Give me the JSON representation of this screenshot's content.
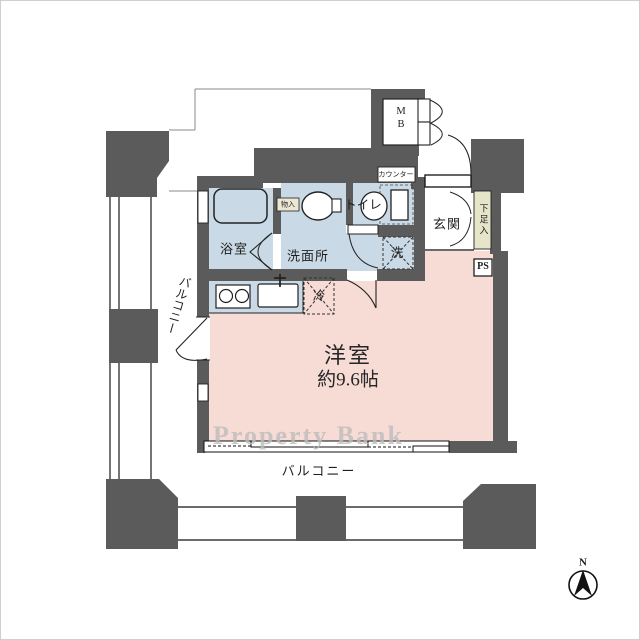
{
  "labels": {
    "main_room_name": "洋室",
    "main_room_size": "約9.6帖",
    "bathroom": "浴室",
    "washroom": "洗面所",
    "toilet": "トイレ",
    "entrance": "玄関",
    "balcony_south": "バルコニー",
    "balcony_west": "バルコニー",
    "shoe_cabinet": "下足入",
    "counter": "カウンター",
    "closet": "物入",
    "washing_machine": "洗",
    "refrigerator": "冷",
    "meter_box_line1": "M",
    "meter_box_line2": "B",
    "pipe_space": "PS"
  },
  "watermark": "Property Bank",
  "compass": {
    "north": "N"
  },
  "colors": {
    "wall": "#5b5b5b",
    "wet": "#c9dae6",
    "room": "#f7dbd5",
    "shoe": "#e7e5c9",
    "closet": "#ece6d2",
    "watermark": "#bdbdbd"
  }
}
